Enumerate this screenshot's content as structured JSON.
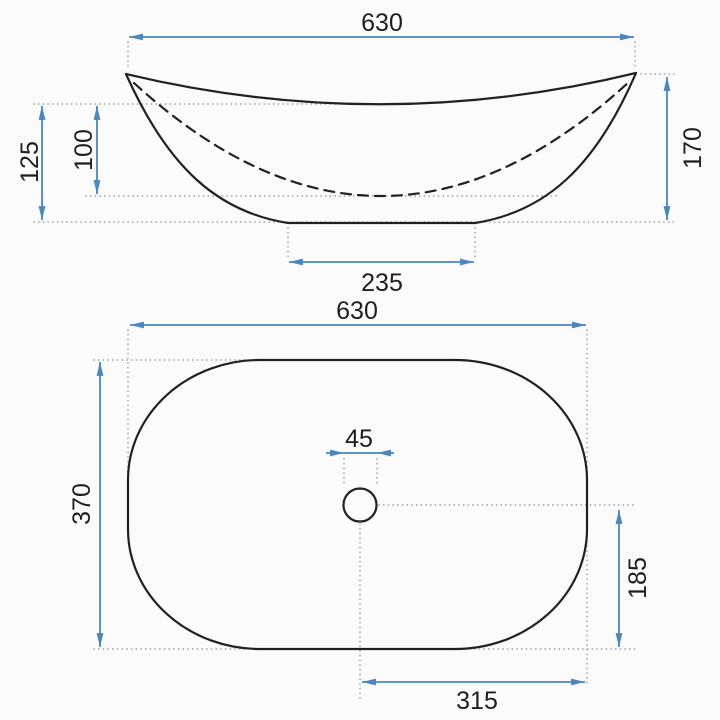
{
  "drawing": {
    "type": "technical-dimension-drawing",
    "subject": "countertop-vessel-washbasin",
    "views": {
      "side": {
        "name": "side-elevation"
      },
      "plan": {
        "name": "top-plan"
      }
    },
    "dimensions": {
      "side_width": "630",
      "side_height": "170",
      "side_total_depth": "125",
      "side_inner_depth": "100",
      "side_base_width": "235",
      "plan_width": "630",
      "plan_depth": "370",
      "drain_diameter": "45",
      "drain_to_bottom_edge": "185",
      "drain_to_right_edge": "315"
    },
    "colors": {
      "dimension_line": "#4a86c0",
      "outline": "#212121",
      "construction_dots": "#99a6ad",
      "label_text": "#1e1e1e",
      "background": "#fbfbfb"
    }
  }
}
